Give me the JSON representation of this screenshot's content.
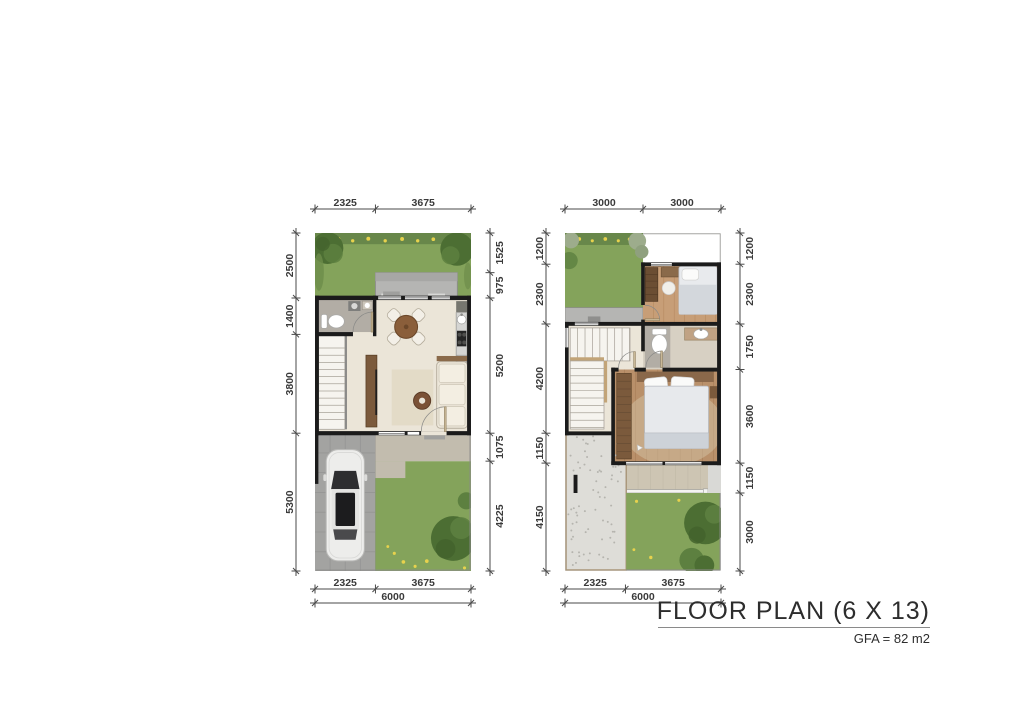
{
  "title": {
    "text": "FLOOR PLAN (6 X 13)",
    "gfa": "GFA = 82 m2"
  },
  "plans": [
    {
      "id": "ground-floor",
      "width_mm": 6000,
      "height_mm": 13000,
      "dims": {
        "top": [
          2325,
          3675
        ],
        "left": [
          2500,
          1400,
          3800,
          5300
        ],
        "right": [
          1525,
          975,
          5200,
          1075,
          4225
        ],
        "bottom": [
          2325,
          3675
        ],
        "total": 6000
      }
    },
    {
      "id": "upper-floor",
      "width_mm": 6000,
      "height_mm": 13000,
      "dims": {
        "top": [
          3000,
          3000
        ],
        "left": [
          1200,
          2300,
          4200,
          1150,
          4150
        ],
        "right": [
          1200,
          2300,
          1750,
          3600,
          1150,
          3000
        ],
        "bottom": [
          2325,
          3675
        ],
        "total": 6000
      }
    }
  ],
  "colors": {
    "grass": "#84a35b",
    "planting_border": "#68874a",
    "tree": "#4c6e33",
    "wall": "#1b1b1b",
    "floor": "#ebe5d8",
    "wood": "#7b5a3c",
    "wood_floor": "#b9906a",
    "paving": "#b5b5b3",
    "carport": "#a3a3a1",
    "gravel": "#deddd8",
    "dim_text": "#3a3a3a"
  }
}
